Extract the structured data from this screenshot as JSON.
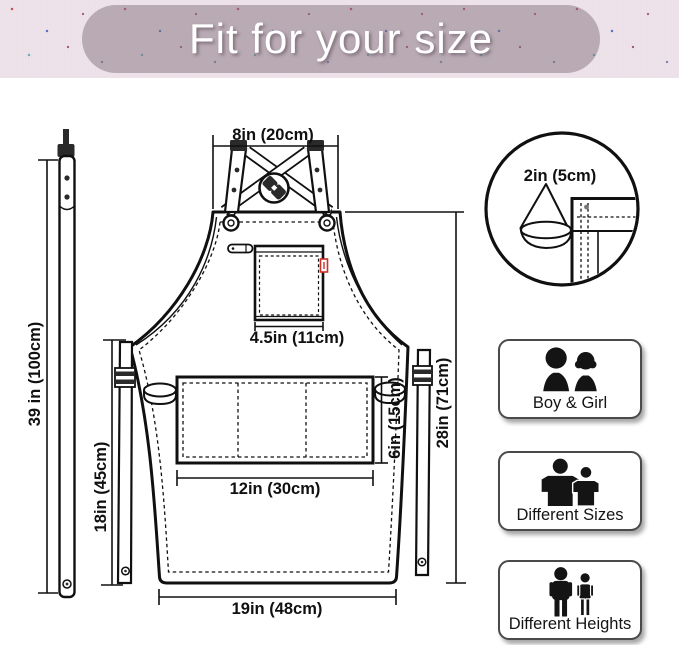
{
  "banner": {
    "title": "Fit for your size",
    "bg_color": "#ece1e8",
    "pill_color": "#b5a8b1",
    "text_color": "#ffffff"
  },
  "diagram": {
    "ink_color": "#101010",
    "tag_color": "#cf3128",
    "dims": {
      "strap_length": "39 in (100cm)",
      "neck_width": "8in (20cm)",
      "hem_detail": "2in (5cm)",
      "chest_pocket_width": "4.5in (11cm)",
      "side_length": "18in (45cm)",
      "front_pocket_height": "6in (15cm)",
      "front_pocket_width": "12in (30cm)",
      "apron_length": "28in (71cm)",
      "bottom_width": "19in (48cm)"
    }
  },
  "cards": [
    {
      "label": "Boy & Girl",
      "icon": "boy-girl-icon"
    },
    {
      "label": "Different Sizes",
      "icon": "different-sizes-icon"
    },
    {
      "label": "Different Heights",
      "icon": "different-heights-icon"
    }
  ]
}
